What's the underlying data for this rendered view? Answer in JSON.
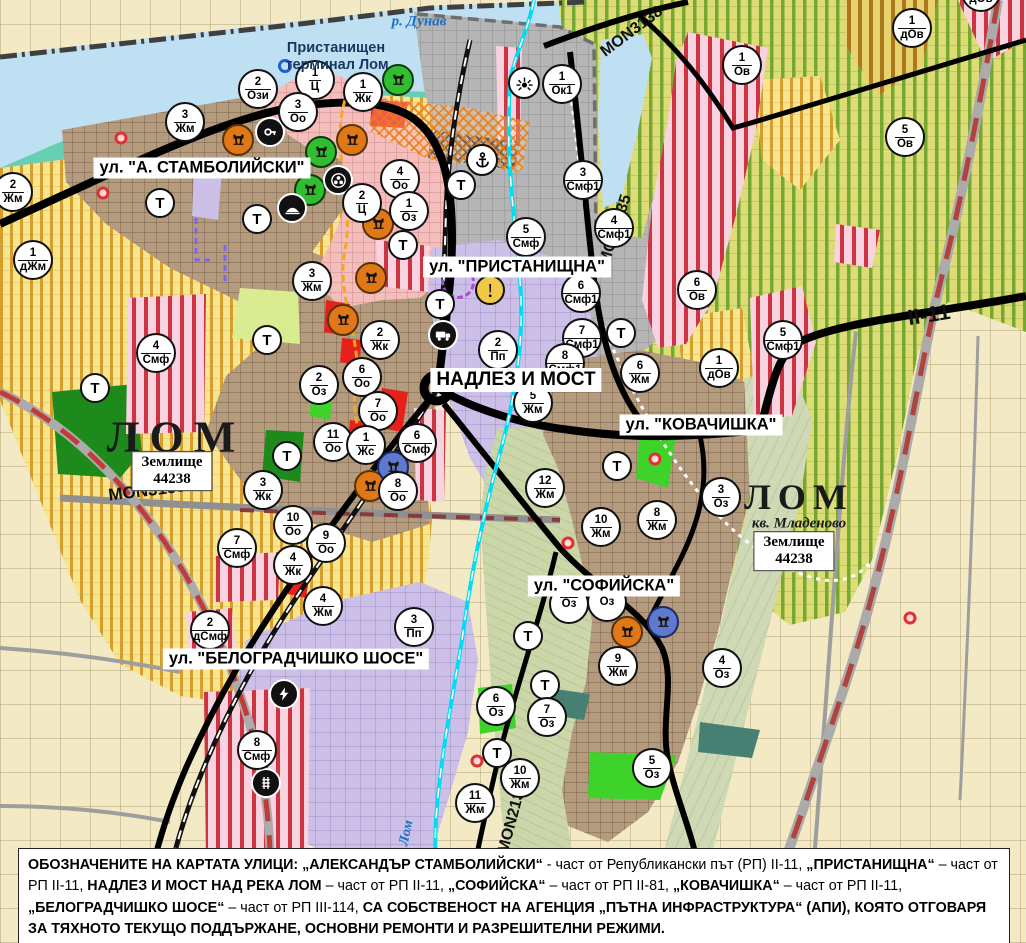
{
  "colors": {
    "water": "#BFE0F2",
    "shore": "#66CFB4",
    "port_grey": "#B5B5B5",
    "farmland": "#F3E9C4",
    "villa_zone": "#DEDC77",
    "villa_stripe": "#6AA22A",
    "yellow_zone": "#F7E58F",
    "yellow_stripe": "#D3921C",
    "urban_brown": "#B59B7E",
    "central_pink": "#F4BEBC",
    "industrial_lavender": "#CCC0E8",
    "mixed_stripe": "#CB2B39",
    "green_area": "#3ED32A",
    "park_green": "#1E8A1C",
    "canal_cyan": "#00DDF2",
    "boundary_red": "#C23B35",
    "road_black": "#000000",
    "monument_orange": "#E07818",
    "monument_green": "#2EBE30",
    "monument_blue": "#5F79CE",
    "warning_yellow": "#F2C84B"
  },
  "area_labels": [
    {
      "id": "river-danube",
      "text": "р. Дунав",
      "x": 419,
      "y": 22,
      "cls": "river"
    },
    {
      "id": "port-terminal-line1",
      "text": "Пристанищен",
      "x": 336,
      "y": 48,
      "cls": "port"
    },
    {
      "id": "port-terminal-line2",
      "text": "терминал Лом",
      "x": 337,
      "y": 65,
      "cls": "port"
    },
    {
      "id": "city-lom-west",
      "text": "ЛОМ",
      "x": 176,
      "y": 437,
      "cls": "city-large"
    },
    {
      "id": "city-lom-east",
      "text": "ЛОМ",
      "x": 799,
      "y": 497,
      "cls": "city-medium"
    },
    {
      "id": "district-mladenovo",
      "text": "кв. Младеново",
      "x": 799,
      "y": 524,
      "cls": "district"
    },
    {
      "id": "river-lom",
      "text": "Лом",
      "x": 407,
      "y": 833,
      "cls": "river-rot",
      "rot": -78
    }
  ],
  "land_boxes": [
    {
      "line1": "Землище",
      "line2": "44238",
      "x": 172,
      "y": 471
    },
    {
      "line1": "Землище",
      "line2": "44238",
      "x": 794,
      "y": 551
    }
  ],
  "street_labels": [
    {
      "text": "ул. \"А. СТАМБОЛИЙСКИ\"",
      "x": 202,
      "y": 168
    },
    {
      "text": "ул. \"ПРИСТАНИЩНА\"",
      "x": 517,
      "y": 267
    },
    {
      "text": "НАДЛЕЗ И МОСТ",
      "x": 516,
      "y": 380,
      "size": 19
    },
    {
      "text": "ул. \"КОВАЧИШКА\"",
      "x": 701,
      "y": 425
    },
    {
      "text": "ул. \"СОФИЙСКА\"",
      "x": 604,
      "y": 586
    },
    {
      "text": "ул. \"БЕЛОГРАДЧИШКО ШОСЕ\"",
      "x": 296,
      "y": 659
    }
  ],
  "road_labels": [
    {
      "text": "MON3138",
      "x": 632,
      "y": 32,
      "rot": -37,
      "size": 16
    },
    {
      "text": "MON2135",
      "x": 616,
      "y": 230,
      "rot": -72,
      "size": 16
    },
    {
      "text": "MON3139",
      "x": 147,
      "y": 491,
      "rot": -7,
      "size": 17
    },
    {
      "text": "MON2136",
      "x": 513,
      "y": 818,
      "rot": -75,
      "size": 16
    },
    {
      "text": "II-11",
      "x": 929,
      "y": 315,
      "rot": -9,
      "size": 22
    }
  ],
  "zone_markers": [
    {
      "num": "2",
      "code": "Ози",
      "x": 258,
      "y": 89
    },
    {
      "num": "1",
      "code": "Ц",
      "x": 315,
      "y": 80
    },
    {
      "num": "1",
      "code": "Жк",
      "x": 363,
      "y": 92
    },
    {
      "num": "3",
      "code": "Оо",
      "x": 298,
      "y": 112
    },
    {
      "num": "3",
      "code": "Жм",
      "x": 185,
      "y": 122
    },
    {
      "num": "2",
      "code": "Жм",
      "x": 13,
      "y": 192
    },
    {
      "num": "1",
      "code": "дЖм",
      "x": 33,
      "y": 260
    },
    {
      "num": "4",
      "code": "Оо",
      "x": 400,
      "y": 179
    },
    {
      "num": "2",
      "code": "Ц",
      "x": 362,
      "y": 203
    },
    {
      "num": "1",
      "code": "Оз",
      "x": 409,
      "y": 211
    },
    {
      "num": "3",
      "code": "Жм",
      "x": 312,
      "y": 281
    },
    {
      "num": "1",
      "code": "Ок1",
      "x": 562,
      "y": 84
    },
    {
      "num": "3",
      "code": "Смф1",
      "x": 583,
      "y": 180
    },
    {
      "num": "4",
      "code": "Смф1",
      "x": 614,
      "y": 228
    },
    {
      "num": "5",
      "code": "Смф",
      "x": 526,
      "y": 237
    },
    {
      "num": "1",
      "code": "Ов",
      "x": 742,
      "y": 65
    },
    {
      "num": "5",
      "code": "Ов",
      "x": 905,
      "y": 137
    },
    {
      "num": "6",
      "code": "Ов",
      "x": 697,
      "y": 290
    },
    {
      "num": "1",
      "code": "дОв",
      "x": 912,
      "y": 28
    },
    {
      "num": "1",
      "code": "дОв",
      "x": 981,
      "y": -8
    },
    {
      "num": "6",
      "code": "Смф1",
      "x": 581,
      "y": 293
    },
    {
      "num": "7",
      "code": "Смф1",
      "x": 582,
      "y": 338
    },
    {
      "num": "8",
      "code": "Смф1",
      "x": 565,
      "y": 363
    },
    {
      "num": "2",
      "code": "Жк",
      "x": 380,
      "y": 340
    },
    {
      "num": "6",
      "code": "Оо",
      "x": 362,
      "y": 377
    },
    {
      "num": "2",
      "code": "Оз",
      "x": 319,
      "y": 385
    },
    {
      "num": "7",
      "code": "Оо",
      "x": 378,
      "y": 411
    },
    {
      "num": "11",
      "code": "Оо",
      "x": 333,
      "y": 442
    },
    {
      "num": "1",
      "code": "Жс",
      "x": 366,
      "y": 445
    },
    {
      "num": "6",
      "code": "Смф",
      "x": 417,
      "y": 443
    },
    {
      "num": "8",
      "code": "Оо",
      "x": 398,
      "y": 491
    },
    {
      "num": "2",
      "code": "Пп",
      "x": 498,
      "y": 350
    },
    {
      "num": "5",
      "code": "Жм",
      "x": 533,
      "y": 403
    },
    {
      "num": "12",
      "code": "Жм",
      "x": 545,
      "y": 488
    },
    {
      "num": "3",
      "code": "Жк",
      "x": 263,
      "y": 490
    },
    {
      "num": "10",
      "code": "Оо",
      "x": 293,
      "y": 525
    },
    {
      "num": "9",
      "code": "Оо",
      "x": 326,
      "y": 543
    },
    {
      "num": "4",
      "code": "Жк",
      "x": 293,
      "y": 565
    },
    {
      "num": "4",
      "code": "Смф",
      "x": 156,
      "y": 353
    },
    {
      "num": "7",
      "code": "Смф",
      "x": 237,
      "y": 548
    },
    {
      "num": "4",
      "code": "Жм",
      "x": 323,
      "y": 606
    },
    {
      "num": "2",
      "code": "дСмф",
      "x": 210,
      "y": 630
    },
    {
      "num": "3",
      "code": "Пп",
      "x": 414,
      "y": 627
    },
    {
      "num": "8",
      "code": "Смф",
      "x": 257,
      "y": 750
    },
    {
      "num": "6",
      "code": "Жм",
      "x": 640,
      "y": 373
    },
    {
      "num": "1",
      "code": "дОв",
      "x": 719,
      "y": 368
    },
    {
      "num": "5",
      "code": "Смф1",
      "x": 783,
      "y": 340
    },
    {
      "num": "3",
      "code": "Оз",
      "x": 721,
      "y": 497
    },
    {
      "num": "8",
      "code": "Жм",
      "x": 657,
      "y": 520
    },
    {
      "num": "10",
      "code": "Жм",
      "x": 601,
      "y": 527
    },
    {
      "num": "9",
      "code": "Жм",
      "x": 618,
      "y": 666
    },
    {
      "num": "4",
      "code": "Оз",
      "x": 722,
      "y": 668
    },
    {
      "num": "5",
      "code": "Оз",
      "x": 652,
      "y": 768
    },
    {
      "num": "6",
      "code": "Оз",
      "x": 496,
      "y": 706
    },
    {
      "num": "7",
      "code": "Оз",
      "x": 547,
      "y": 717
    },
    {
      "num": "10",
      "code": "Жм",
      "x": 520,
      "y": 778
    },
    {
      "num": "11",
      "code": "Жм",
      "x": 475,
      "y": 803
    },
    {
      "num": "",
      "code": "Оз",
      "x": 569,
      "y": 604
    },
    {
      "num": "",
      "code": "Оз",
      "x": 607,
      "y": 602
    }
  ],
  "t_markers": [
    {
      "x": 160,
      "y": 203
    },
    {
      "x": 257,
      "y": 219
    },
    {
      "x": 95,
      "y": 388
    },
    {
      "x": 267,
      "y": 340
    },
    {
      "x": 287,
      "y": 456
    },
    {
      "x": 403,
      "y": 245
    },
    {
      "x": 440,
      "y": 304
    },
    {
      "x": 461,
      "y": 185
    },
    {
      "x": 621,
      "y": 333
    },
    {
      "x": 617,
      "y": 466
    },
    {
      "x": 528,
      "y": 636
    },
    {
      "x": 545,
      "y": 685
    },
    {
      "x": 497,
      "y": 753
    }
  ],
  "icon_markers": [
    {
      "type": "monument-column-icon",
      "color": "orange",
      "x": 238,
      "y": 140
    },
    {
      "type": "monument-column-icon",
      "color": "orange",
      "x": 352,
      "y": 140
    },
    {
      "type": "monument-column-icon",
      "color": "orange",
      "x": 378,
      "y": 224
    },
    {
      "type": "monument-column-icon",
      "color": "orange",
      "x": 371,
      "y": 278
    },
    {
      "type": "monument-column-icon",
      "color": "orange",
      "x": 343,
      "y": 320
    },
    {
      "type": "monument-column-icon",
      "color": "orange",
      "x": 370,
      "y": 486
    },
    {
      "type": "monument-column-icon",
      "color": "orange",
      "x": 627,
      "y": 632
    },
    {
      "type": "monument-column-icon",
      "color": "green",
      "x": 398,
      "y": 80
    },
    {
      "type": "monument-column-icon",
      "color": "green",
      "x": 321,
      "y": 152
    },
    {
      "type": "monument-column-icon",
      "color": "green",
      "x": 310,
      "y": 190
    },
    {
      "type": "monument-column-icon",
      "color": "blue",
      "x": 393,
      "y": 467
    },
    {
      "type": "monument-column-icon",
      "color": "blue",
      "x": 663,
      "y": 622
    },
    {
      "type": "key-icon",
      "color": "black",
      "x": 270,
      "y": 132
    },
    {
      "type": "people-icon",
      "color": "black",
      "x": 338,
      "y": 180
    },
    {
      "type": "mound-icon",
      "color": "black",
      "x": 292,
      "y": 208
    },
    {
      "type": "anchor-icon",
      "color": "white",
      "x": 482,
      "y": 160
    },
    {
      "type": "sun-icon",
      "color": "white",
      "x": 524,
      "y": 83
    },
    {
      "type": "warning-icon",
      "color": "yellow",
      "x": 490,
      "y": 290
    },
    {
      "type": "truck-icon",
      "color": "black",
      "x": 443,
      "y": 335
    },
    {
      "type": "lightning-icon",
      "color": "black",
      "x": 284,
      "y": 694
    },
    {
      "type": "rail-crossing-icon",
      "color": "black",
      "x": 266,
      "y": 783
    }
  ],
  "poi_dots": [
    {
      "x": 121,
      "y": 138
    },
    {
      "x": 103,
      "y": 193
    },
    {
      "x": 568,
      "y": 543
    },
    {
      "x": 655,
      "y": 459
    },
    {
      "x": 910,
      "y": 618
    },
    {
      "x": 477,
      "y": 761
    }
  ],
  "blue_rings": [
    {
      "x": 285,
      "y": 66
    }
  ],
  "dashed_rings": [
    {
      "x": 458,
      "y": 282
    }
  ],
  "note": {
    "segments": [
      {
        "b": true,
        "t": "ОБОЗНАЧЕНИТЕ НА КАРТАТА УЛИЦИ: „АЛЕКСАНДЪР СТАМБОЛИЙСКИ“"
      },
      {
        "b": false,
        "t": " - част от Републикански път (РП) II-11, "
      },
      {
        "b": true,
        "t": "„ПРИСТАНИЩНА“"
      },
      {
        "b": false,
        "t": " – част от РП II-11, "
      },
      {
        "b": true,
        "t": "НАДЛЕЗ И МОСТ НАД РЕКА ЛОМ"
      },
      {
        "b": false,
        "t": " – част от РП II-11, "
      },
      {
        "b": true,
        "t": "„СОФИЙСКА“"
      },
      {
        "b": false,
        "t": " – част от РП II-81, "
      },
      {
        "b": true,
        "t": "„КОВАЧИШКА“"
      },
      {
        "b": false,
        "t": " – част от РП II-11, "
      },
      {
        "b": true,
        "t": "„БЕЛОГРАДЧИШКО ШОСЕ“"
      },
      {
        "b": false,
        "t": " – част от РП III-114, "
      },
      {
        "b": true,
        "t": "СА СОБСТВЕНОСТ НА АГЕНЦИЯ „ПЪТНА ИНФРАСТРУКТУРА“ (АПИ), КОЯТО ОТГОВАРЯ ЗА ТЯХНОТО ТЕКУЩО ПОДДЪРЖАНЕ, ОСНОВНИ РЕМОНТИ И РАЗРЕШИТЕЛНИ РЕЖИМИ."
      }
    ]
  }
}
